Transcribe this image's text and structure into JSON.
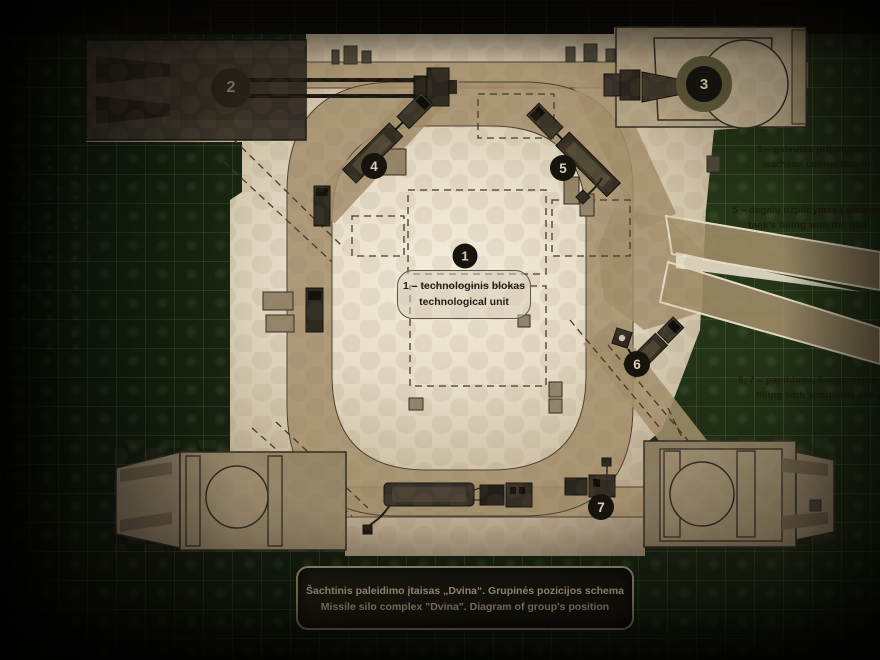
{
  "markers": {
    "m1": "1",
    "m2": "2",
    "m3": "3",
    "m4": "4",
    "m5": "5",
    "m6": "6",
    "m7": "7"
  },
  "center_label": {
    "line1": "1 – technologinis blokas",
    "line2": "technological unit"
  },
  "legend": {
    "item3": {
      "lt": "3 – galvutės prijungimas prie raketos",
      "en": "warhead connection to the missile"
    },
    "item5": {
      "lt": "5 – degalų užpildymas į sistemą",
      "en": "tank's filling with the fuel"
    },
    "item67": {
      "lt": "6, 7 – papildomų komponentų užpildymas",
      "en": "filling with additional components"
    }
  },
  "caption": {
    "lt": "Šachtinis paleidimo įtaisas „Dvina“. Grupinės pozicijos schema",
    "en": "Missile silo complex \"Dvina\". Diagram of group's position"
  },
  "colors": {
    "panel_paper": "#e7ddc8",
    "road_tan": "#a58f6c",
    "quilt_green": "#283a19",
    "marker_bg": "#17140e",
    "plaque_text": "#cfc19e"
  }
}
